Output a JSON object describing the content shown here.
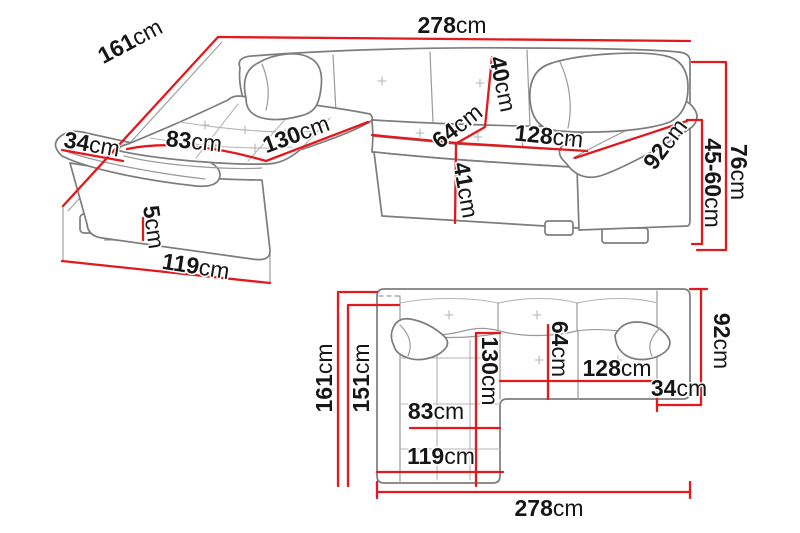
{
  "diagram": {
    "subject": "corner-sofa-dimension-diagram",
    "unit": "cm",
    "colors": {
      "dimension_line": "#e2191d",
      "sofa_outline": "#7d7d7d",
      "stitch_detail": "#b5b5b5",
      "label_text": "#161616",
      "background": "#ffffff"
    },
    "perspective": {
      "dims": {
        "width_total": {
          "num": "278",
          "unit": "cm"
        },
        "depth_total": {
          "num": "161",
          "unit": "cm"
        },
        "armrest_left": {
          "num": "34",
          "unit": "cm"
        },
        "chaise_seat_width": {
          "num": "83",
          "unit": "cm"
        },
        "chaise_length": {
          "num": "130",
          "unit": "cm"
        },
        "backrest_height": {
          "num": "40",
          "unit": "cm"
        },
        "seat_depth": {
          "num": "64",
          "unit": "cm"
        },
        "seat_width": {
          "num": "128",
          "unit": "cm"
        },
        "armrest_right": {
          "num": "92",
          "unit": "cm"
        },
        "seat_front_height": {
          "num": "41",
          "unit": "cm"
        },
        "leg_height": {
          "num": "5",
          "unit": "cm"
        },
        "chaise_front": {
          "num": "119",
          "unit": "cm"
        },
        "seat_height_range": {
          "num": "45-60",
          "unit": "cm"
        },
        "total_height": {
          "num": "76",
          "unit": "cm"
        }
      }
    },
    "plan": {
      "dims": {
        "depth_total": {
          "num": "161",
          "unit": "cm"
        },
        "depth_inner": {
          "num": "151",
          "unit": "cm"
        },
        "chaise_length": {
          "num": "130",
          "unit": "cm"
        },
        "seat_depth": {
          "num": "64",
          "unit": "cm"
        },
        "seat_width": {
          "num": "128",
          "unit": "cm"
        },
        "armrest_width": {
          "num": "34",
          "unit": "cm"
        },
        "armrest_depth": {
          "num": "92",
          "unit": "cm"
        },
        "chaise_seat_width": {
          "num": "83",
          "unit": "cm"
        },
        "chaise_front": {
          "num": "119",
          "unit": "cm"
        },
        "width_total": {
          "num": "278",
          "unit": "cm"
        }
      }
    }
  }
}
